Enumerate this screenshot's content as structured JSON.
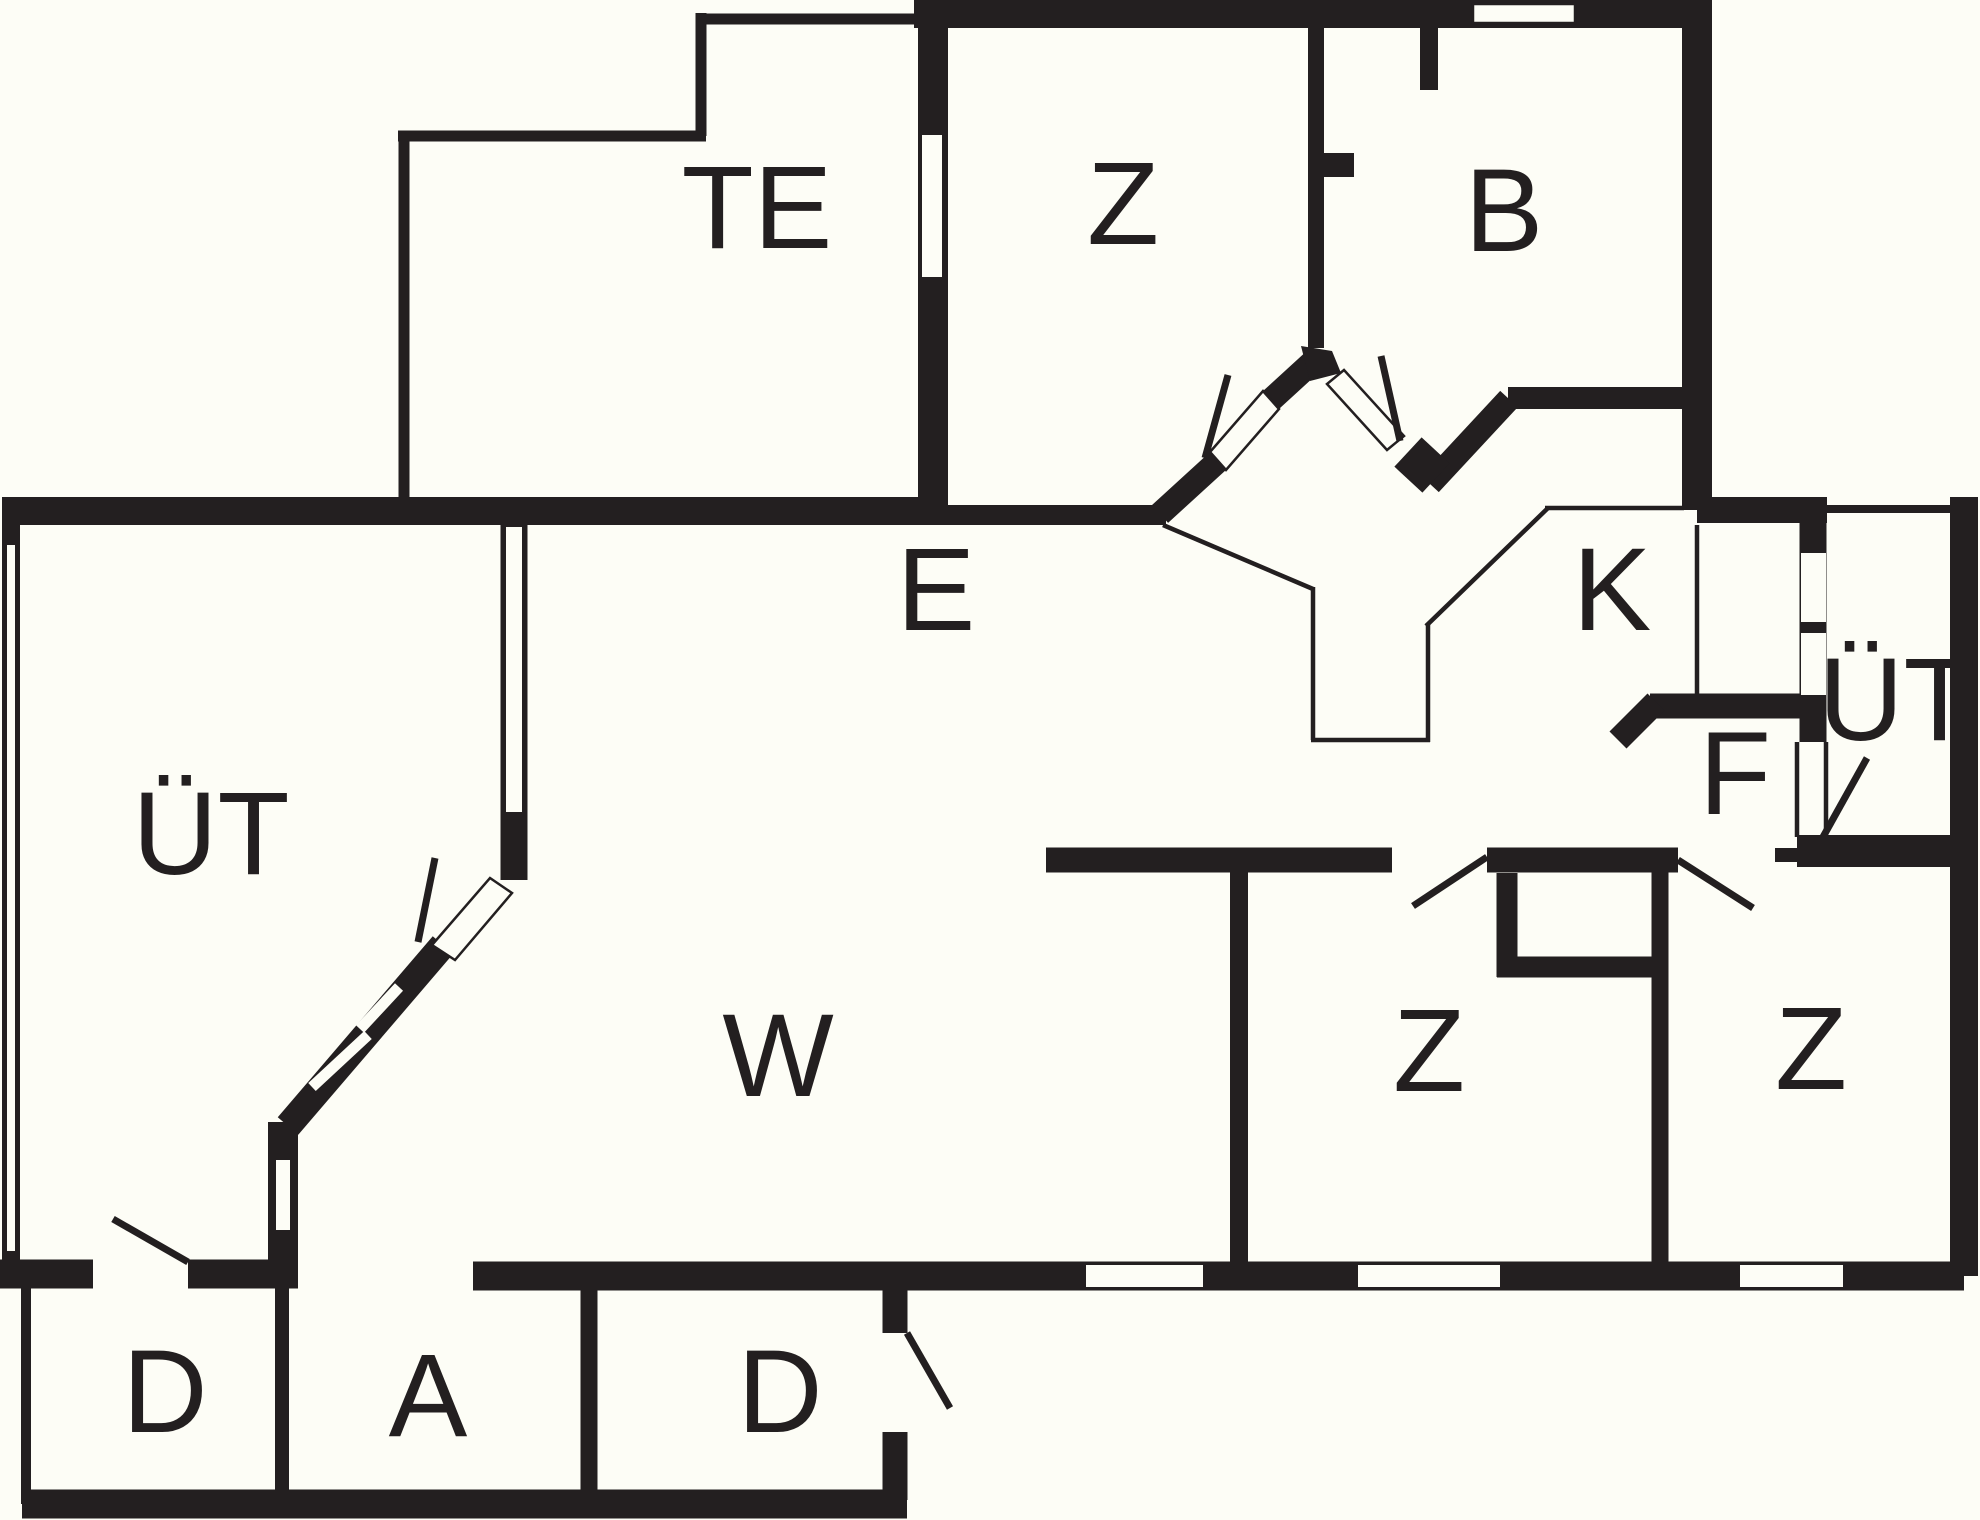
{
  "canvas": {
    "width": 1980,
    "height": 1520,
    "background_color": "#fdfdf6",
    "wall_color": "#231f20",
    "label_font_size": 118
  },
  "rooms": [
    {
      "id": "te",
      "label": "TE",
      "x": 757,
      "y": 208
    },
    {
      "id": "z-top",
      "label": "Z",
      "x": 1123,
      "y": 204
    },
    {
      "id": "b",
      "label": "B",
      "x": 1504,
      "y": 211
    },
    {
      "id": "e",
      "label": "E",
      "x": 936,
      "y": 590
    },
    {
      "id": "k",
      "label": "K",
      "x": 1612,
      "y": 590
    },
    {
      "id": "ut-left",
      "label": "ÜT",
      "x": 211,
      "y": 834
    },
    {
      "id": "ut-right",
      "label": "ÜT",
      "x": 1897,
      "y": 700
    },
    {
      "id": "f",
      "label": "F",
      "x": 1735,
      "y": 774
    },
    {
      "id": "w",
      "label": "W",
      "x": 778,
      "y": 1056
    },
    {
      "id": "z-bottom-left",
      "label": "Z",
      "x": 1429,
      "y": 1051
    },
    {
      "id": "z-bottom-right",
      "label": "Z",
      "x": 1811,
      "y": 1049
    },
    {
      "id": "d-left",
      "label": "D",
      "x": 165,
      "y": 1392
    },
    {
      "id": "a",
      "label": "A",
      "x": 428,
      "y": 1396
    },
    {
      "id": "d-right",
      "label": "D",
      "x": 780,
      "y": 1392
    }
  ]
}
